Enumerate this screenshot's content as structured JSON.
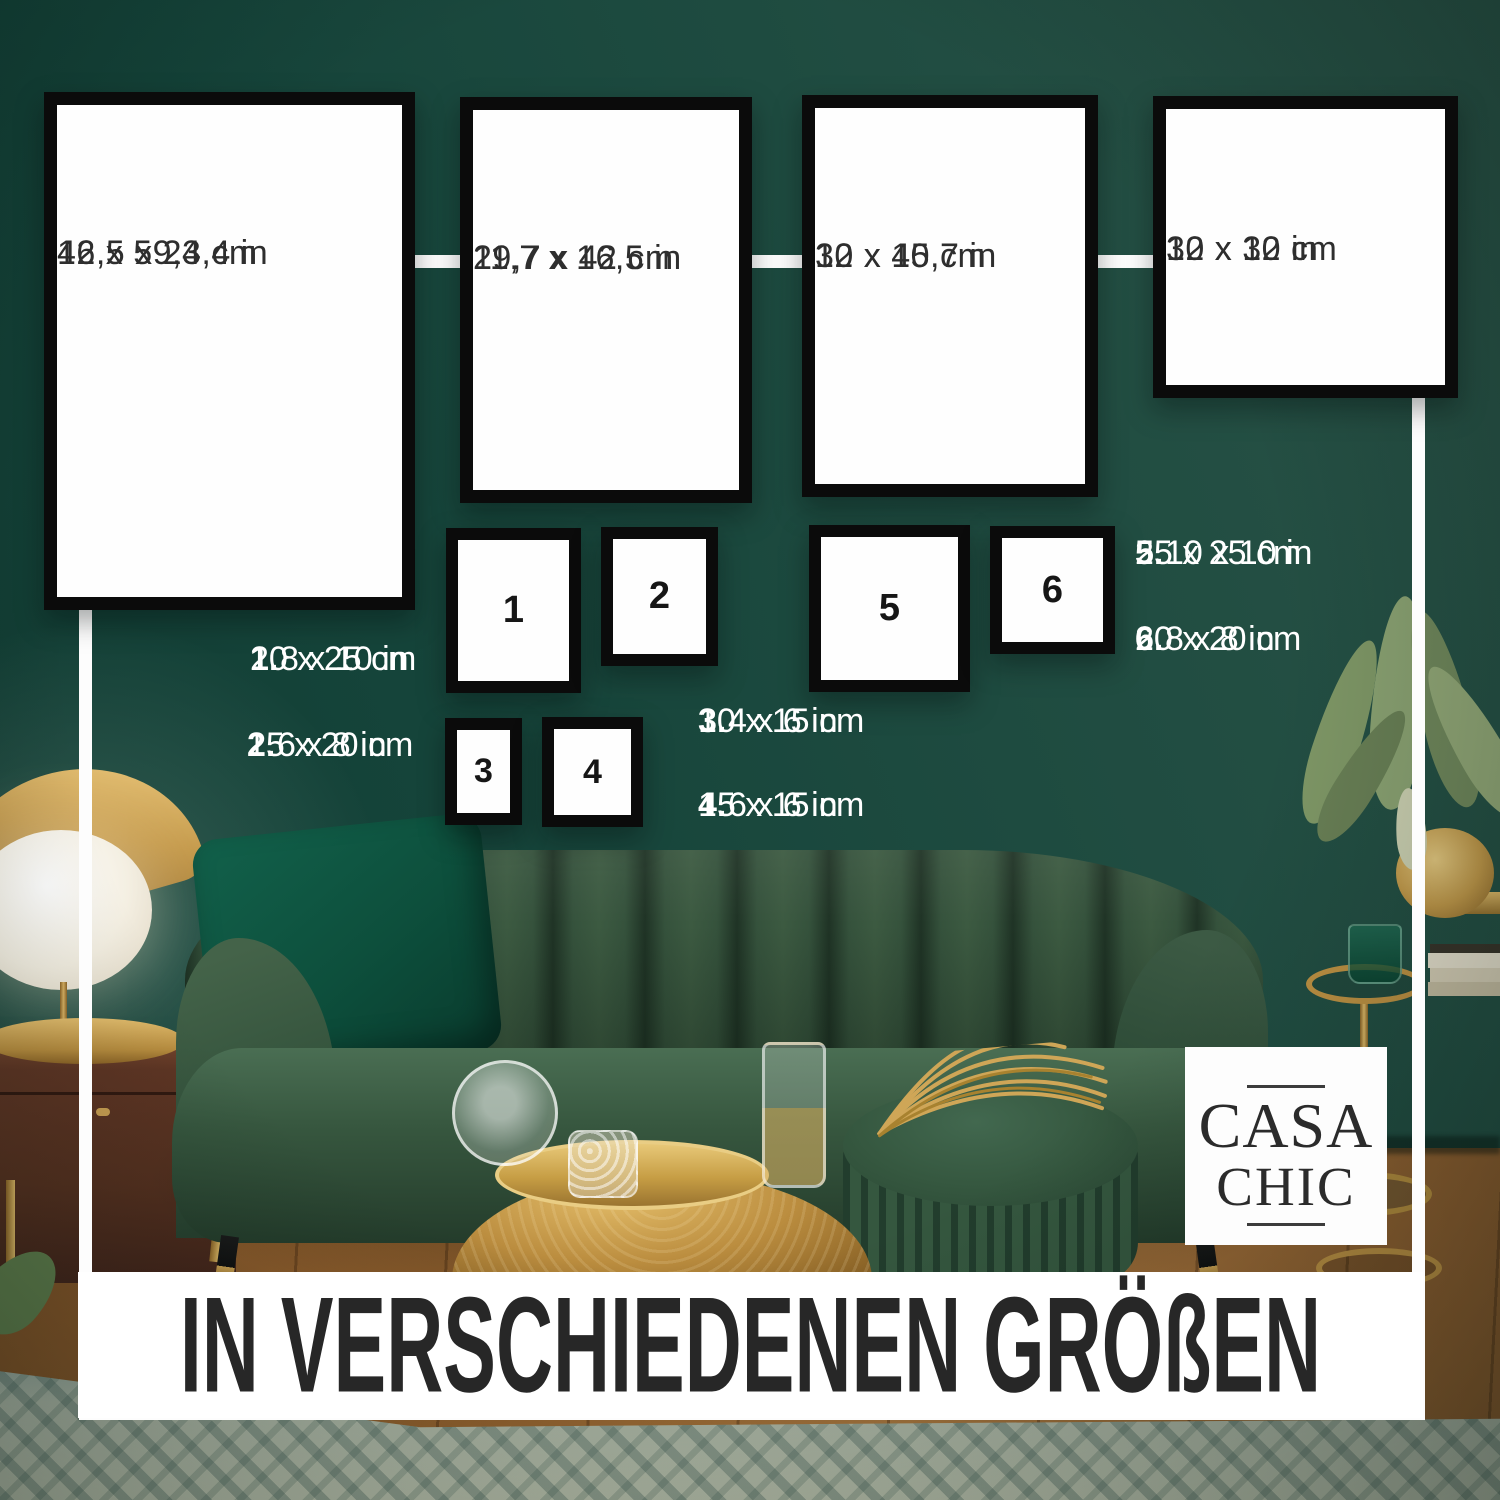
{
  "banner": {
    "title": "IN VERSCHIEDENEN GRÖßEN"
  },
  "brand": {
    "name": "CASA CHIC",
    "line1": "CASA",
    "line2": "CHIC"
  },
  "frames_large": [
    {
      "cm": "42 x 59,4 cm",
      "inches": "16,5 x 23,4 in"
    },
    {
      "cm": "29,7 x 42 cm",
      "inches": "11,7 x 16,5 in"
    },
    {
      "cm": "30 x 40 cm",
      "inches": "12 x 15,7 in"
    },
    {
      "cm": "30 x 30 cm",
      "inches": "12 x 12 in"
    }
  ],
  "frames_numbered": [
    {
      "number": "1"
    },
    {
      "number": "2"
    },
    {
      "number": "5"
    },
    {
      "number": "6"
    },
    {
      "number": "3"
    },
    {
      "number": "4"
    }
  ],
  "legend": [
    {
      "number": "1.",
      "cm": "20 x 25 cm",
      "inches": "8 x 10 in"
    },
    {
      "number": "2.",
      "cm": "15 x 20 cm",
      "inches": "6 x 8 in"
    },
    {
      "number": "3.",
      "cm": "10 x 15 cm",
      "inches": "4 x 6 in"
    },
    {
      "number": "4.",
      "cm": "15 x 15 cm",
      "inches": "6 x 6 in"
    },
    {
      "number": "5.",
      "cm": "25 x 25 cm",
      "inches": "10 x 10 in"
    },
    {
      "number": "6.",
      "cm": "20 x 20 cm",
      "inches": "8 x 8 in"
    }
  ],
  "colors": {
    "wall_green": "#1e4b40",
    "frame_border": "#0b0b0b",
    "frame_fill": "#fefefe",
    "overlay_white": "#fdfdfd",
    "label_dark": "#2e2e2e",
    "banner_text": "#272727",
    "gold": "#c49a4a",
    "sofa_green": "#35523c"
  }
}
